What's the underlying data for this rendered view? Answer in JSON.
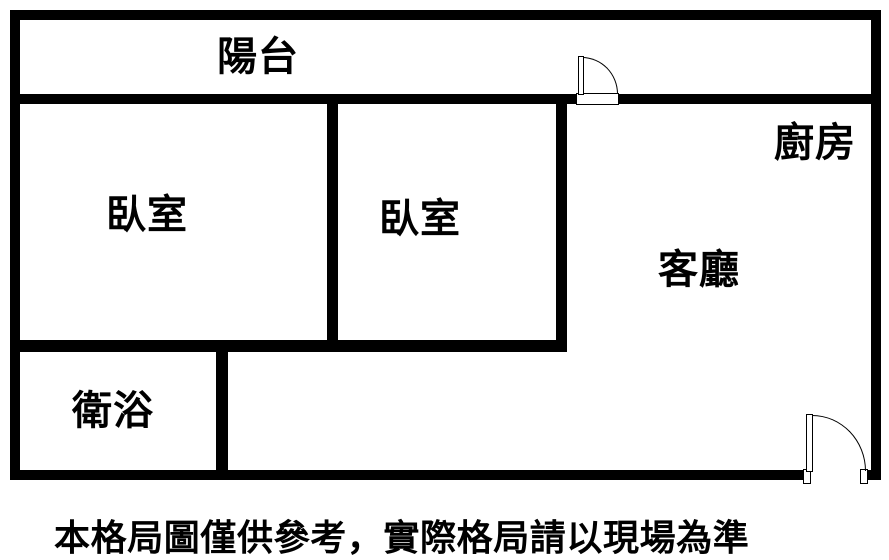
{
  "rooms": {
    "balcony": "陽台",
    "bedroom_left": "臥室",
    "bedroom_middle": "臥室",
    "kitchen": "廚房",
    "living_room": "客廳",
    "bathroom": "衛浴"
  },
  "disclaimer": "本格局圖僅供參考，實際格局請以現場為準",
  "doors": {
    "balcony_door": "quarter-arc swing into balcony",
    "entry_door": "quarter-arc swing at bottom right"
  },
  "colors": {
    "wall": "#000000",
    "background": "#ffffff",
    "text": "#000000"
  }
}
